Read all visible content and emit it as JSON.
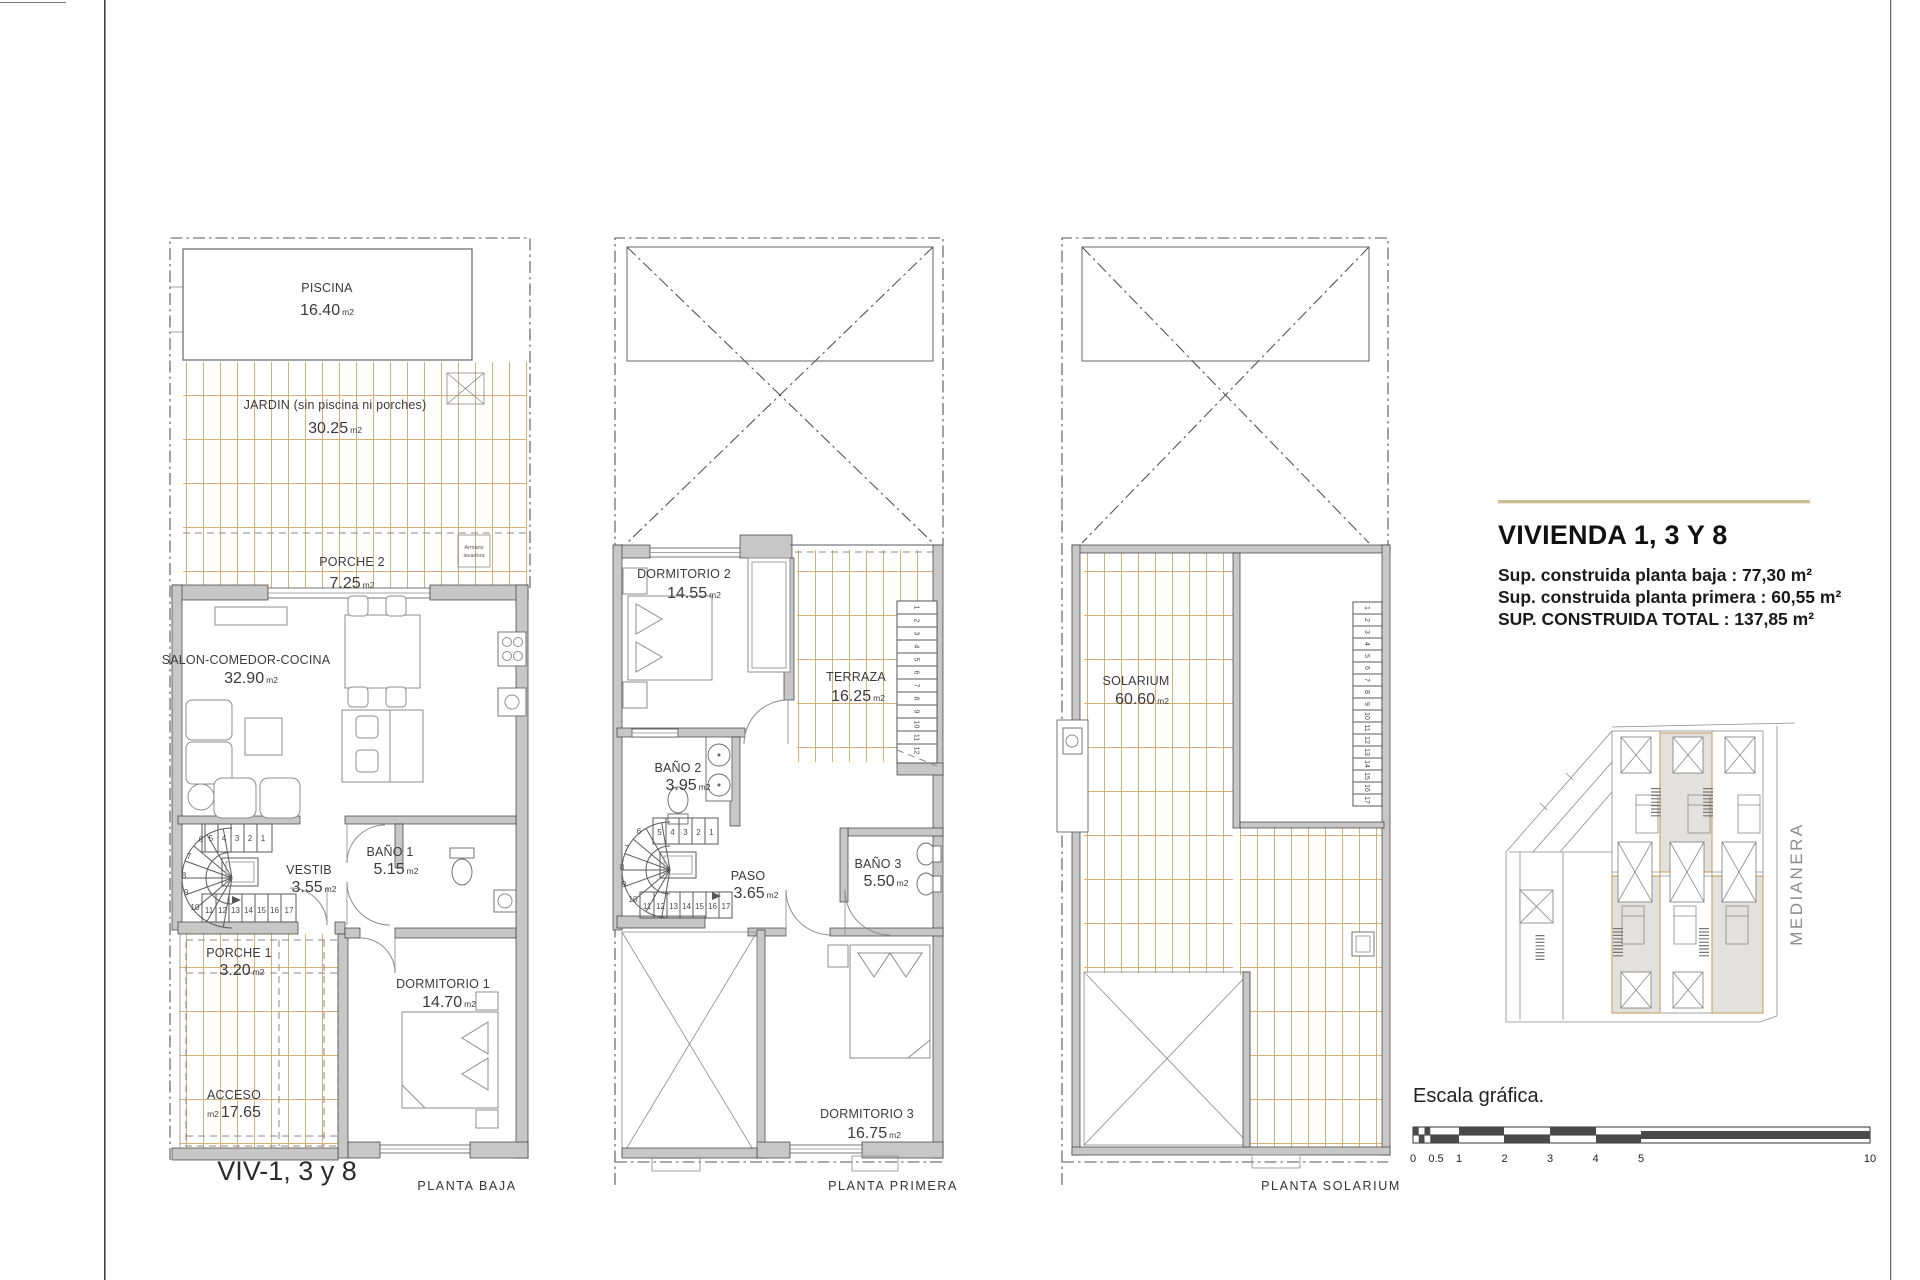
{
  "colors": {
    "grid_tan": "#cfa45f",
    "wall_gray": "#c7c7c7",
    "accent_rule": "#cdbd96",
    "highlight_fill": "#e3e1de",
    "highlight_border": "#c79f62"
  },
  "units": {
    "m2_small": "m2",
    "m2_sup": "m²"
  },
  "plans": {
    "baja": {
      "caption": "VIV-1, 3 y 8",
      "floor_label": "PLANTA BAJA",
      "piscina_name": "PISCINA",
      "piscina_area": "16.40",
      "jardin_name": "JARDIN (sin piscina ni porches)",
      "jardin_area": "30.25",
      "porche2_name": "PORCHE 2",
      "porche2_area": "7.25",
      "armario_line1": "Armario",
      "armario_line2": "lavadora",
      "salon_name": "SALON-COMEDOR-COCINA",
      "salon_area": "32.90",
      "vestib_name": "VESTIB",
      "vestib_area": "3.55",
      "bano1_name": "BAÑO 1",
      "bano1_area": "5.15",
      "porche1_name": "PORCHE 1",
      "porche1_area": "3.20",
      "acceso_name": "ACCESO",
      "acceso_area": "17.65",
      "dorm1_name": "DORMITORIO 1",
      "dorm1_area": "14.70"
    },
    "primera": {
      "floor_label": "PLANTA PRIMERA",
      "dorm2_name": "DORMITORIO 2",
      "dorm2_area": "14.55",
      "terraza_name": "TERRAZA",
      "terraza_area": "16.25",
      "bano2_name": "BAÑO 2",
      "bano2_area": "3.95",
      "paso_name": "PASO",
      "paso_area": "3.65",
      "bano3_name": "BAÑO 3",
      "bano3_area": "5.50",
      "dorm3_name": "DORMITORIO 3",
      "dorm3_area": "16.75"
    },
    "solarium": {
      "floor_label": "PLANTA SOLARIUM",
      "solarium_name": "SOLARIUM",
      "solarium_area": "60.60"
    }
  },
  "stairs": {
    "steps": [
      "1",
      "2",
      "3",
      "4",
      "5",
      "6",
      "7",
      "8",
      "9",
      "10",
      "11",
      "12",
      "13",
      "14",
      "15",
      "16",
      "17"
    ]
  },
  "info": {
    "title": "VIVIENDA 1, 3 Y 8",
    "line1": "Sup. construida planta baja : 77,30 m²",
    "line2": "Sup. construida planta primera : 60,55 m²",
    "line3": "SUP. CONSTRUIDA TOTAL : 137,85 m²"
  },
  "siteplan": {
    "medianera": "MEDIANERA"
  },
  "scale_bar": {
    "label": "Escala gráfica.",
    "ticks": [
      "0",
      "0.5",
      "1",
      "2",
      "3",
      "4",
      "5",
      "10"
    ]
  }
}
